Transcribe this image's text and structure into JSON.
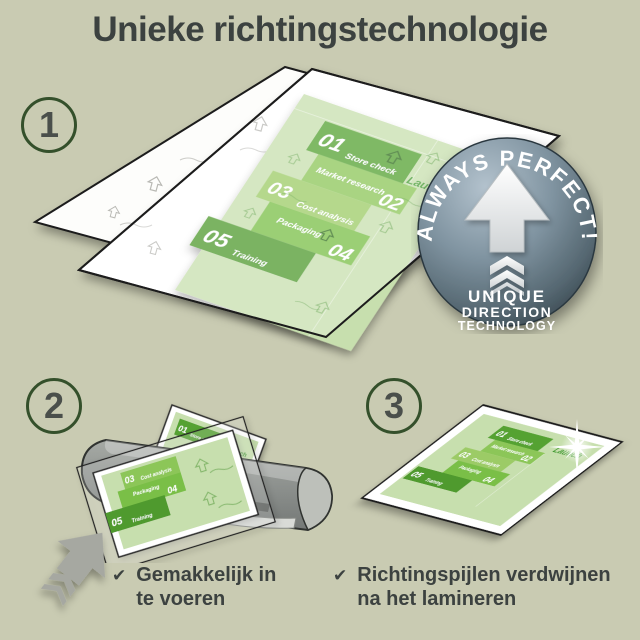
{
  "title": "Unieke richtingstechnologie",
  "badge": {
    "arc_text": "ALWAYS PERFECT!",
    "line1": "UNIQUE",
    "line2": "DIRECTION",
    "line3": "TECHNOLOGY"
  },
  "steps": {
    "step1": "1",
    "step2": "2",
    "step3": "3"
  },
  "doc": {
    "launch": "Launch",
    "items": [
      {
        "num": "01",
        "label": "Store check"
      },
      {
        "num": "02",
        "label": "Market research"
      },
      {
        "num": "03",
        "label": "Cost analysis"
      },
      {
        "num": "04",
        "label": "Packaging"
      },
      {
        "num": "05",
        "label": "Training"
      }
    ]
  },
  "checklist": {
    "item1": {
      "line1": "Gemakkelijk in",
      "line2": "te voeren"
    },
    "item2": {
      "line1": "Richtingspijlen verdwijnen",
      "line2": "na het lamineren"
    }
  },
  "colors": {
    "background": "#c9cbb2",
    "title_text": "#3c4240",
    "step_ring": "#34502b",
    "step_number": "#4a4f4b",
    "doc_background": "#c7dfae",
    "block_dark": "#55a233",
    "block_darker": "#4f9a2f",
    "block_medium": "#7abf46",
    "block_light": "#8cc658",
    "block_lighter": "#9ccb66",
    "badge_top": "#aebecb",
    "badge_bottom": "#37454d",
    "machine_gray": "#8e918e",
    "checklist_text": "#3c4240"
  }
}
